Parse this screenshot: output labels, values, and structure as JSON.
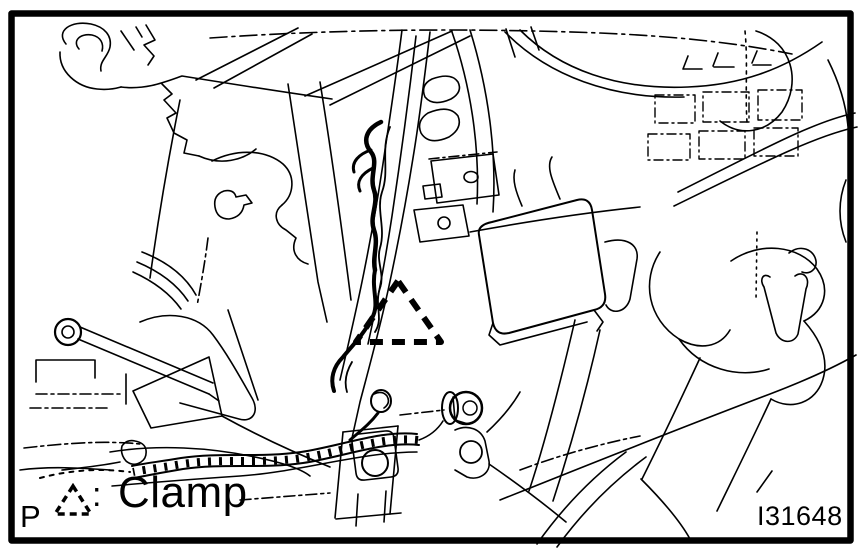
{
  "figure": {
    "code": "I31648",
    "legend": {
      "prefix": "P",
      "symbol": "dashed-triangle",
      "separator": ":",
      "label": "Clamp"
    },
    "marker": {
      "shape": "dashed-triangle",
      "meaning": "Clamp position"
    },
    "colors": {
      "line": "#000000",
      "background": "#ffffff"
    }
  }
}
